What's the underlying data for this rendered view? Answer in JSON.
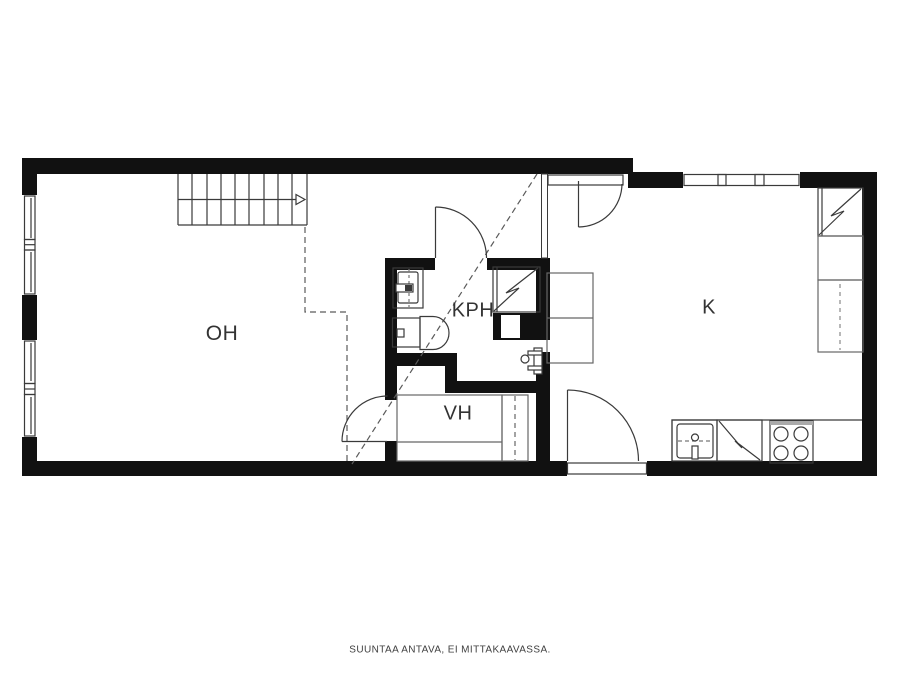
{
  "floorplan": {
    "rooms": [
      {
        "id": "oh",
        "label": "OH"
      },
      {
        "id": "kph",
        "label": "KPH"
      },
      {
        "id": "vh",
        "label": "VH"
      },
      {
        "id": "k",
        "label": "K"
      }
    ],
    "footer": "SUUNTAA ANTAVA, EI MITTAKAAVASSA.",
    "icons": [
      "stairs-icon",
      "stairs-direction-arrow-icon",
      "window-icon",
      "door-arc-icon",
      "sink-icon",
      "toilet-icon",
      "water-heater-icon",
      "duct-icon",
      "tap-icon",
      "wardrobe-icon",
      "hall-cabinet-icon",
      "fridge-icon",
      "kitchen-cabinet-icon",
      "kitchen-sink-icon",
      "dishwasher-icon",
      "stove-icon",
      "ceiling-height-dashed-line"
    ],
    "colors": {
      "wall": "#111111",
      "fixture_line": "#3a3a3a",
      "furniture_line": "#666666",
      "dashed_line": "#5a5a5a",
      "background": "#ffffff",
      "text": "#333333"
    }
  }
}
